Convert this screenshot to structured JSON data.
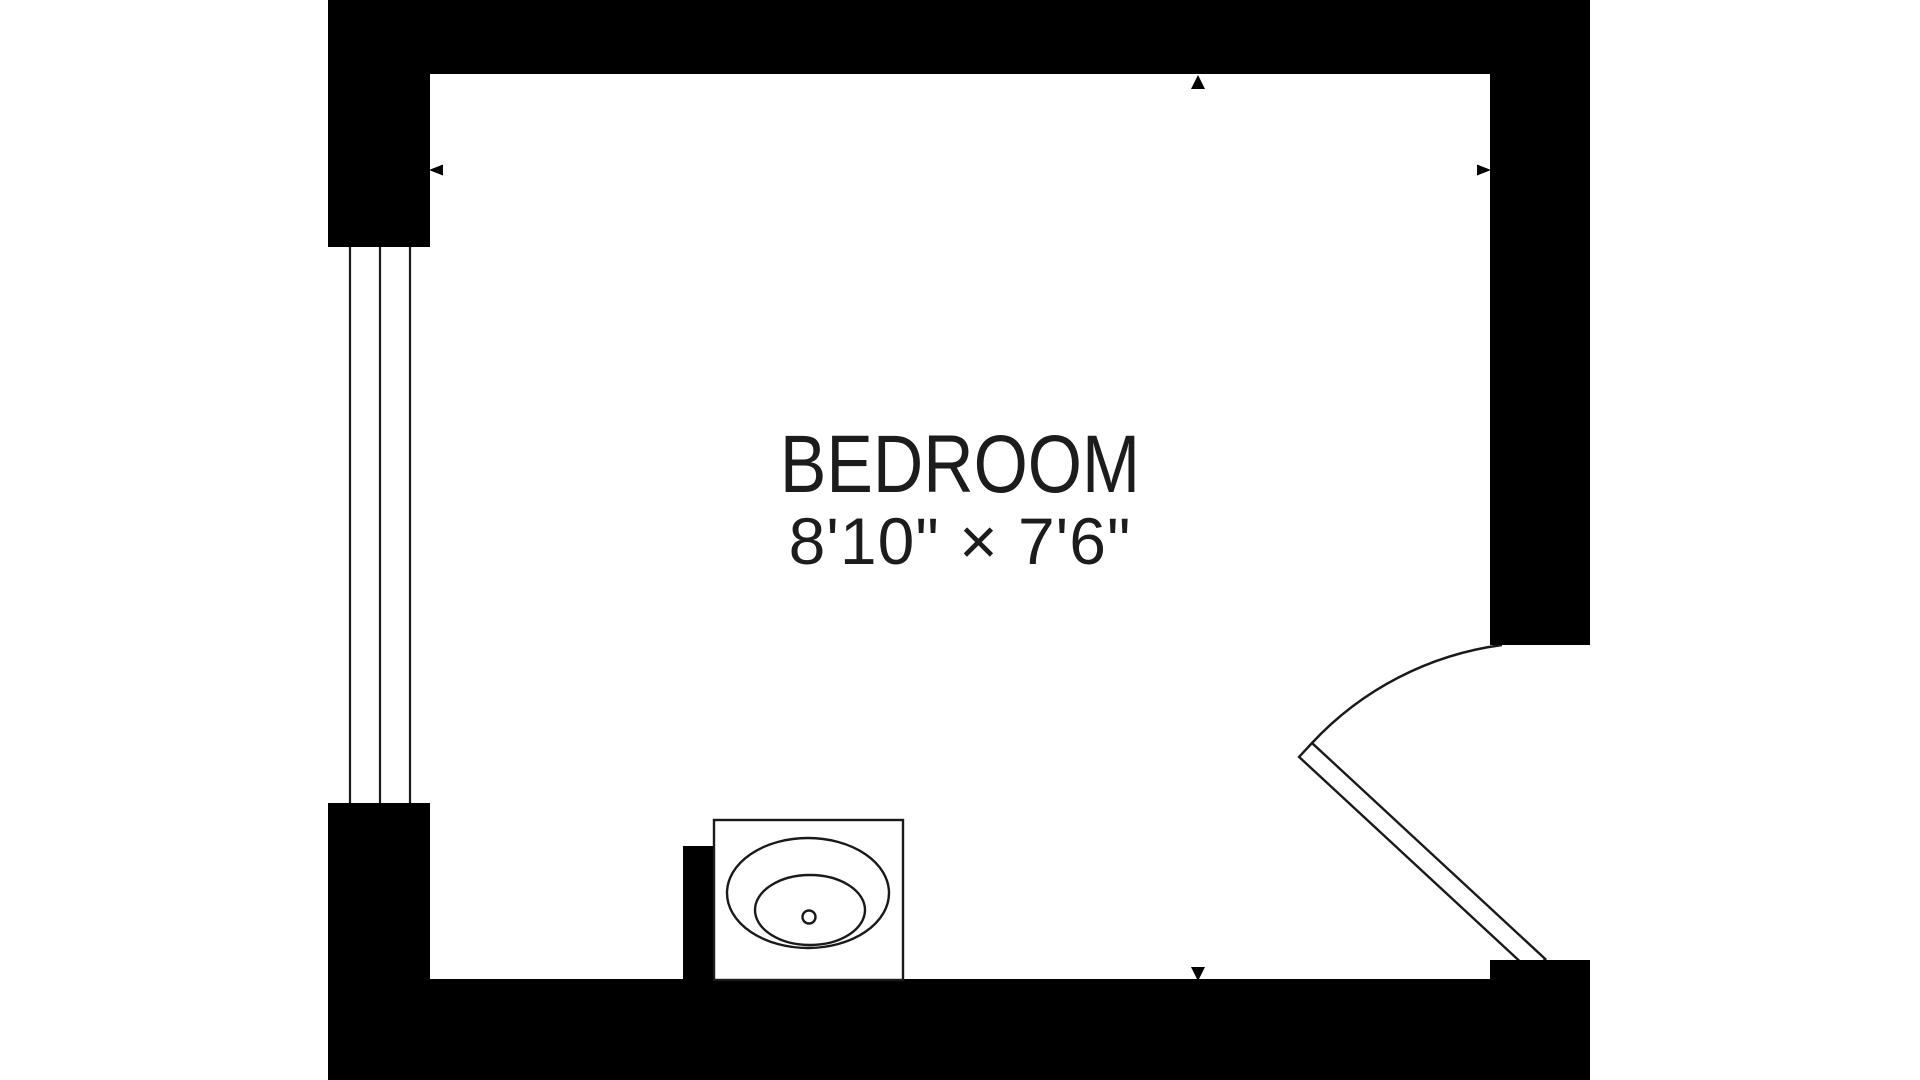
{
  "floorplan": {
    "room": {
      "name": "BEDROOM",
      "dimensions": "8'10\" × 7'6\""
    },
    "features": {
      "window": "window-left-wall",
      "door": "swing-door-right-wall",
      "sink": "sink-vanity-bottom-wall"
    },
    "colors": {
      "wall": "#000000",
      "line": "#1a1a1a",
      "text": "#1c1c1c",
      "background": "#ffffff"
    }
  }
}
